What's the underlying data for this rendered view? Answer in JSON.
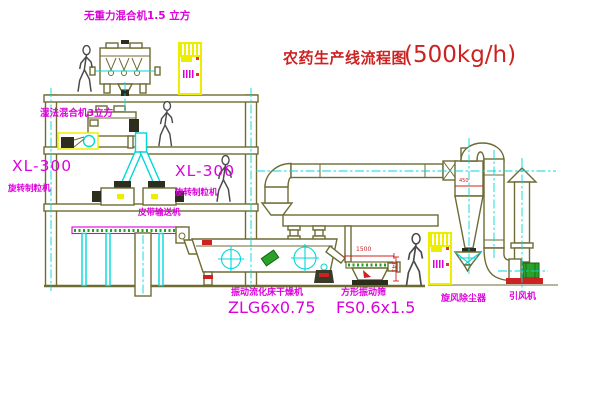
{
  "diagram": {
    "title": "农药生产线流程图",
    "capacity": "(500kg/h)"
  },
  "equipment_labels": {
    "gravity_mixer": "无重力混合机1.5 立方",
    "wet_mixer": "湿法混合机3立方",
    "granulator_left": {
      "model": "XL-300",
      "name": "旋转制粒机"
    },
    "granulator_mid": {
      "model": "XL-300",
      "name": "旋转制粒机"
    },
    "belt_conveyor": "皮带输送机",
    "fluid_bed_dryer": {
      "name": "振动流化床干燥机",
      "model": "ZLG6x0.75"
    },
    "square_sieve": {
      "name": "方形振动筛",
      "model": "FS0.6x1.5"
    },
    "cyclone": "旋风除尘器",
    "induced_draft_fan": "引风机"
  },
  "dimensions": {
    "sieve_length": "1500",
    "sieve_height": "541",
    "cyclone_note": "450"
  },
  "colors": {
    "line": "#6e6b33",
    "centerline_pipe": "#00d8d8",
    "label": "#dd00dd",
    "title": "#cc2222",
    "cabinet": "#eded00",
    "motor": "#2aa22a",
    "background": "#ffffff"
  }
}
